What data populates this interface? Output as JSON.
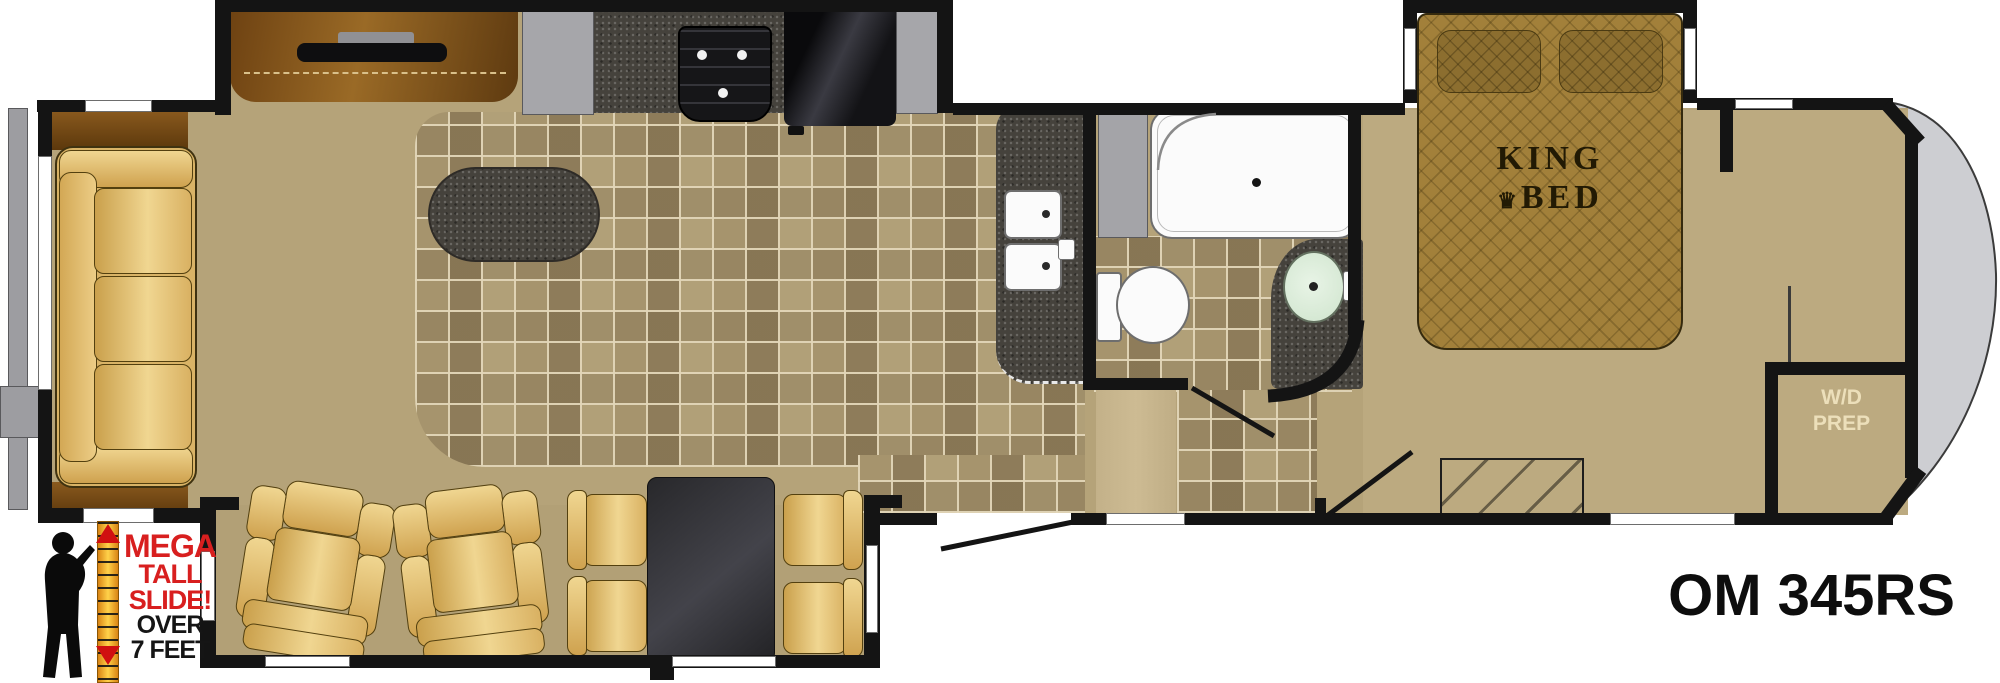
{
  "floorplan": {
    "model": "OM 345RS",
    "bed_label": {
      "line1": "KING",
      "line2": "BED",
      "crown": "♛"
    },
    "wd_closet": {
      "line1": "W/D",
      "line2": "PREP"
    },
    "slide_callout": {
      "word1": "MEGA",
      "word2": "TALL",
      "word3": "SLIDE!",
      "word4": "OVER",
      "word5": "7 FEET"
    }
  },
  "colors": {
    "wall": "#141414",
    "carpet": "#b5a379",
    "bedroom_carpet": "#bcaa80",
    "tile_light": "#a6946d",
    "tile_dark": "#8e7c5a",
    "grout": "#e2d6b8",
    "granite": "#45423c",
    "wood": "#7a4c16",
    "upholstery": "#e9c878",
    "bed_quilt": "#a2803a",
    "callout_red": "#d81f1f",
    "front_cap": "#cdced2",
    "fixture_white": "#fafafa",
    "sink_mint": "#dcefdc"
  },
  "icons": [
    "sofa",
    "recliner",
    "dinette-table",
    "dining-chair",
    "kitchen-island",
    "double-sink",
    "cooktop",
    "refrigerator",
    "tv",
    "dresser",
    "pantry",
    "shower",
    "toilet",
    "bathroom-sink",
    "linen-cabinet",
    "king-bed",
    "pillow",
    "steps",
    "wd-prep-closet",
    "entry-door",
    "door-swing",
    "height-ruler",
    "person-silhouette",
    "front-cap",
    "rear-bumper",
    "window"
  ]
}
